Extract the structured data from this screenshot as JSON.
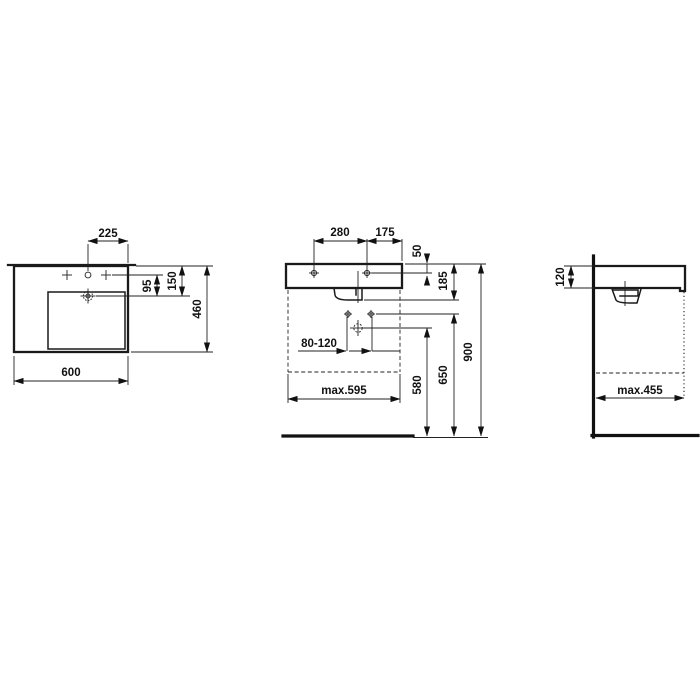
{
  "background_color": "#ffffff",
  "line_color": "#1a1a1a",
  "drawing_type": "washbasin installation technical drawing, three orthographic views",
  "views": {
    "top_view": {
      "dims": {
        "tap_to_right_edge": "225",
        "tap_to_drain": "95",
        "edge_to_drain": "150",
        "depth": "460",
        "width": "600"
      }
    },
    "front_view": {
      "dims": {
        "fixing_hole_spacing": "280",
        "hole_to_edge": "175",
        "hole_from_top": "50",
        "top_to_siphon": "185",
        "drain_offset_range": "80-120",
        "drain_height": "580",
        "valve_height": "650",
        "rim_height": "900",
        "clearance_width": "max.595"
      }
    },
    "side_view": {
      "dims": {
        "front_apron_height": "120",
        "clearance_depth": "max.455"
      }
    }
  }
}
